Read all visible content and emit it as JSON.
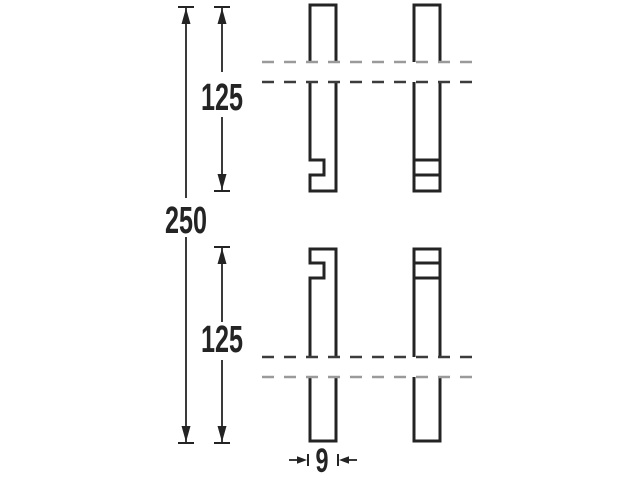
{
  "diagram": {
    "type": "technical-dimension-drawing",
    "description": "Two interlocking board halves shown in side and front view with break lines",
    "dimensions": {
      "overall_length": {
        "label": "250"
      },
      "upper_half_length": {
        "label": "125"
      },
      "lower_half_length": {
        "label": "125"
      },
      "thickness": {
        "label": "9"
      }
    },
    "colors": {
      "line": "#242424",
      "background": "#ffffff",
      "break_dash_light": "#9a9a9a",
      "break_dash_dark": "#3c3c3c"
    }
  }
}
